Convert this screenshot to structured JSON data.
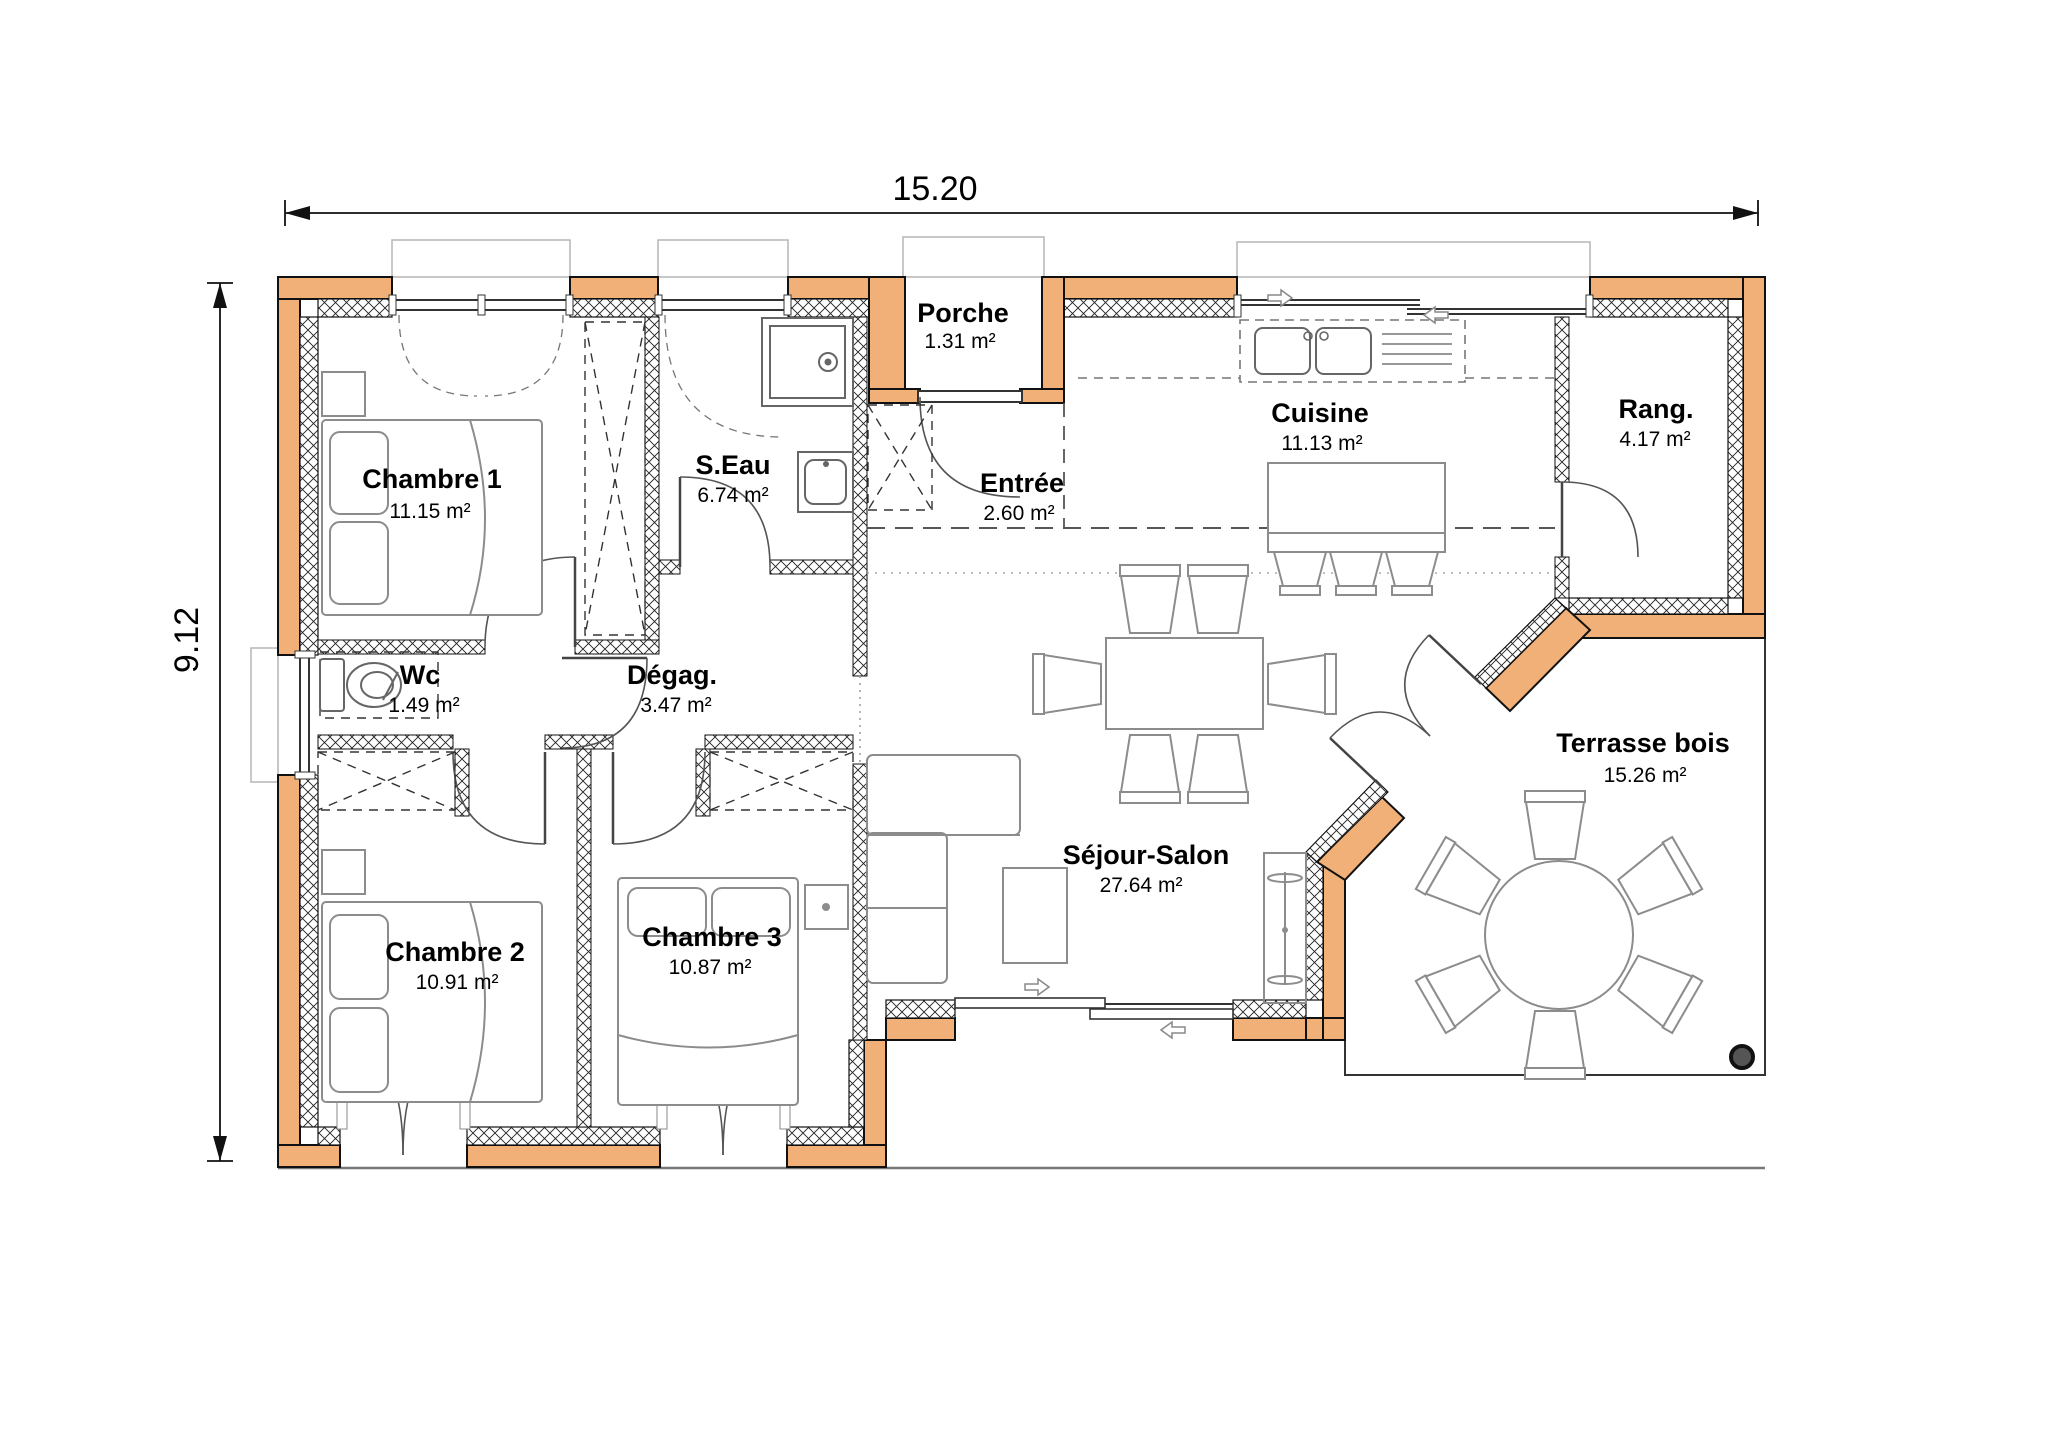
{
  "plan": {
    "title": "floor-plan",
    "dimensions": {
      "width_m": "15.20",
      "height_m": "9.12"
    },
    "colors": {
      "wall_fill": "#F0B077",
      "outline": "#111111",
      "furniture": "#8c8c8c"
    },
    "rooms": [
      {
        "name": "Chambre 1",
        "area": "11.15 m²"
      },
      {
        "name": "S.Eau",
        "area": "6.74 m²"
      },
      {
        "name": "Porche",
        "area": "1.31 m²"
      },
      {
        "name": "Entrée",
        "area": "2.60 m²"
      },
      {
        "name": "Cuisine",
        "area": "11.13 m²"
      },
      {
        "name": "Rang.",
        "area": "4.17 m²"
      },
      {
        "name": "Wc",
        "area": "1.49 m²"
      },
      {
        "name": "Dégag.",
        "area": "3.47 m²"
      },
      {
        "name": "Chambre 2",
        "area": "10.91 m²"
      },
      {
        "name": "Chambre 3",
        "area": "10.87 m²"
      },
      {
        "name": "Séjour-Salon",
        "area": "27.64 m²"
      },
      {
        "name": "Terrasse bois",
        "area": "15.26 m²"
      }
    ]
  }
}
